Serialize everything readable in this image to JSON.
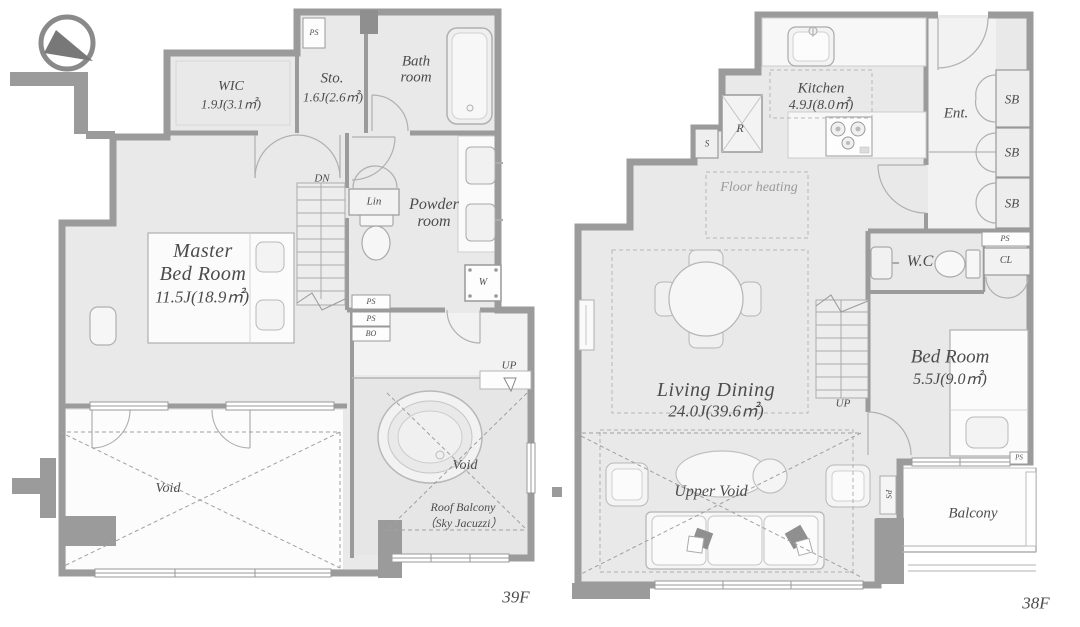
{
  "palette": {
    "wall": "#9b9b9b",
    "floor": "#e9e9e9",
    "void_fill": "#fcfcfc",
    "text": "#4c4c4c",
    "dash": "#a8a8a8"
  },
  "floor_39": {
    "floor_label": "39F",
    "wic_name": "WIC",
    "wic_size": "1.9J(3.1㎡)",
    "sto_name": "Sto.",
    "sto_size": "1.6J(2.6㎡)",
    "bath_name_line1": "Bath",
    "bath_name_line2": "room",
    "master_name_line1": "Master",
    "master_name_line2": "Bed Room",
    "master_size": "11.5J(18.9㎡)",
    "powder_name_line1": "Powder",
    "powder_name_line2": "room",
    "lin_label": "Lin",
    "dn_label": "DN",
    "up_label": "UP",
    "washer_label": "W",
    "ps_top": "PS",
    "ps_powder": "PS",
    "ps_shaft": "PS",
    "bo_shaft": "BO",
    "void_label": "Void",
    "roof_void_label": "Void",
    "roof_balcony_line1": "Roof Balcony",
    "roof_balcony_line2": "（Sky Jacuzzi）"
  },
  "floor_38": {
    "floor_label": "38F",
    "kitchen_name": "Kitchen",
    "kitchen_size": "4.9J(8.0㎡)",
    "fridge_label": "R",
    "s_label": "S",
    "entrance_label": "Ent.",
    "sb1": "SB",
    "sb2": "SB",
    "sb3": "SB",
    "ps_closet": "PS",
    "closet_label": "CL",
    "wc_label": "W.C",
    "floor_heating_label": "Floor heating",
    "living_name": "Living Dining",
    "living_size": "24.0J(39.6㎡)",
    "up_label": "UP",
    "bed_name": "Bed Room",
    "bed_size": "5.5J(9.0㎡)",
    "ps_bed": "PS",
    "upper_void_label": "Upper Void",
    "balcony_label": "Balcony",
    "ps_balcony": "PS"
  }
}
